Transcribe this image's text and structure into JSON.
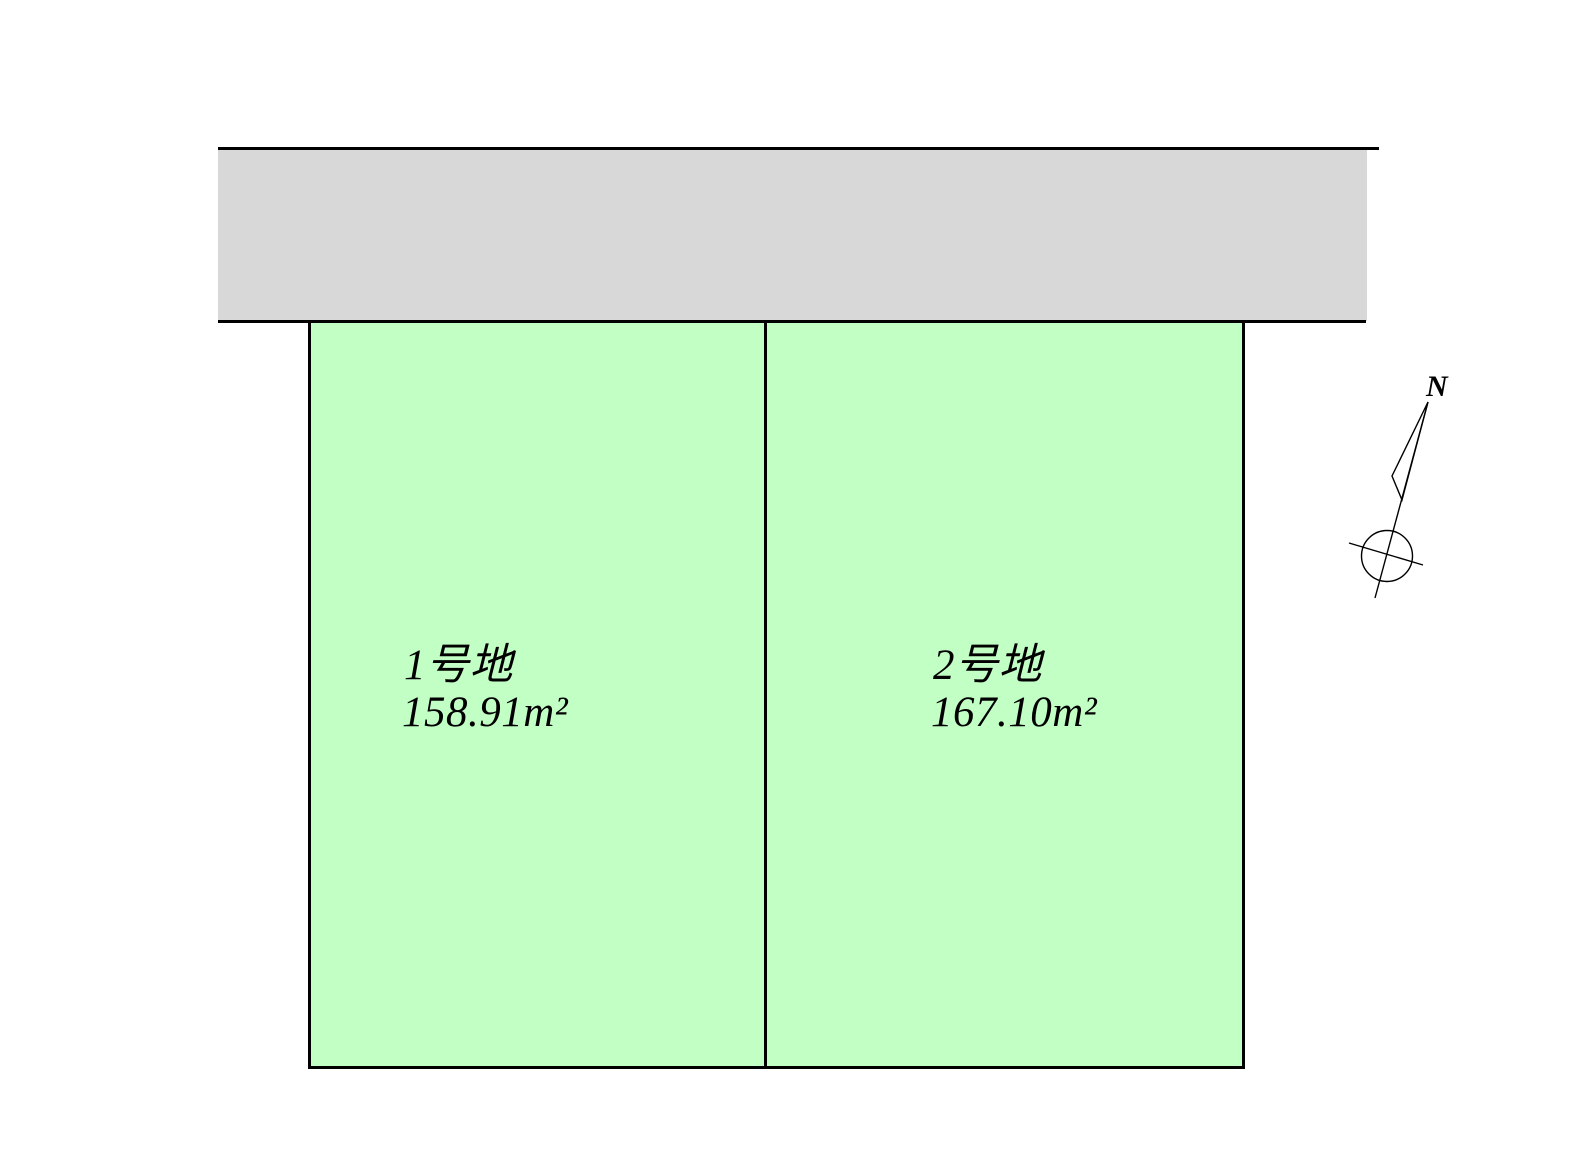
{
  "plan": {
    "background_color": "#ffffff",
    "road_fill_color": "#d8d8d8",
    "lot_fill_color": "#c2ffc5",
    "line_color": "#000000"
  },
  "lots": [
    {
      "name": "1号地",
      "area": "158.91m²"
    },
    {
      "name": "2号地",
      "area": "167.10m²"
    }
  ],
  "compass": {
    "north_label": "N"
  }
}
